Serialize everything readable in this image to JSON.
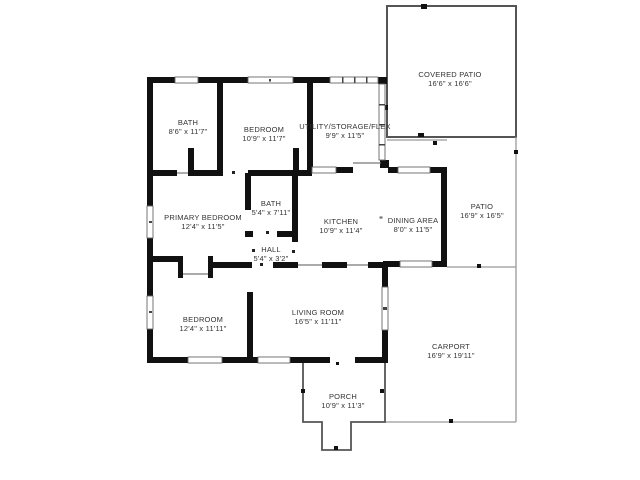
{
  "title": "Residential floor plan",
  "colors": {
    "background": "#ffffff",
    "wall": "#111111",
    "outdoor_outline": "#555555",
    "thin_line": "#999999",
    "label_text": "#333333"
  },
  "rooms": [
    {
      "id": "covered-patio",
      "name": "COVERED PATIO",
      "dims": "16'6\" x 16'6\""
    },
    {
      "id": "bath-1",
      "name": "BATH",
      "dims": "8'6\" x 11'7\""
    },
    {
      "id": "bedroom-1",
      "name": "BEDROOM",
      "dims": "10'9\" x 11'7\""
    },
    {
      "id": "utility",
      "name": "UTILITY/STORAGE/FLEX",
      "dims": "9'9\" x 11'5\""
    },
    {
      "id": "primary-bedroom",
      "name": "PRIMARY BEDROOM",
      "dims": "12'4\" x 11'5\""
    },
    {
      "id": "bath-2",
      "name": "BATH",
      "dims": "5'4\" x 7'11\""
    },
    {
      "id": "kitchen",
      "name": "KITCHEN",
      "dims": "10'9\" x 11'4\""
    },
    {
      "id": "dining-area",
      "name": "DINING AREA",
      "dims": "8'0\" x 11'5\""
    },
    {
      "id": "patio",
      "name": "PATIO",
      "dims": "16'9\" x 16'5\""
    },
    {
      "id": "hall",
      "name": "HALL",
      "dims": "5'4\" x 3'2\""
    },
    {
      "id": "bedroom-2",
      "name": "BEDROOM",
      "dims": "12'4\" x 11'11\""
    },
    {
      "id": "living-room",
      "name": "LIVING ROOM",
      "dims": "16'5\" x 11'11\""
    },
    {
      "id": "carport",
      "name": "CARPORT",
      "dims": "16'9\" x 19'11\""
    },
    {
      "id": "porch",
      "name": "PORCH",
      "dims": "10'9\" x 11'3\""
    }
  ],
  "annotations": {
    "opening_mark": "\""
  }
}
